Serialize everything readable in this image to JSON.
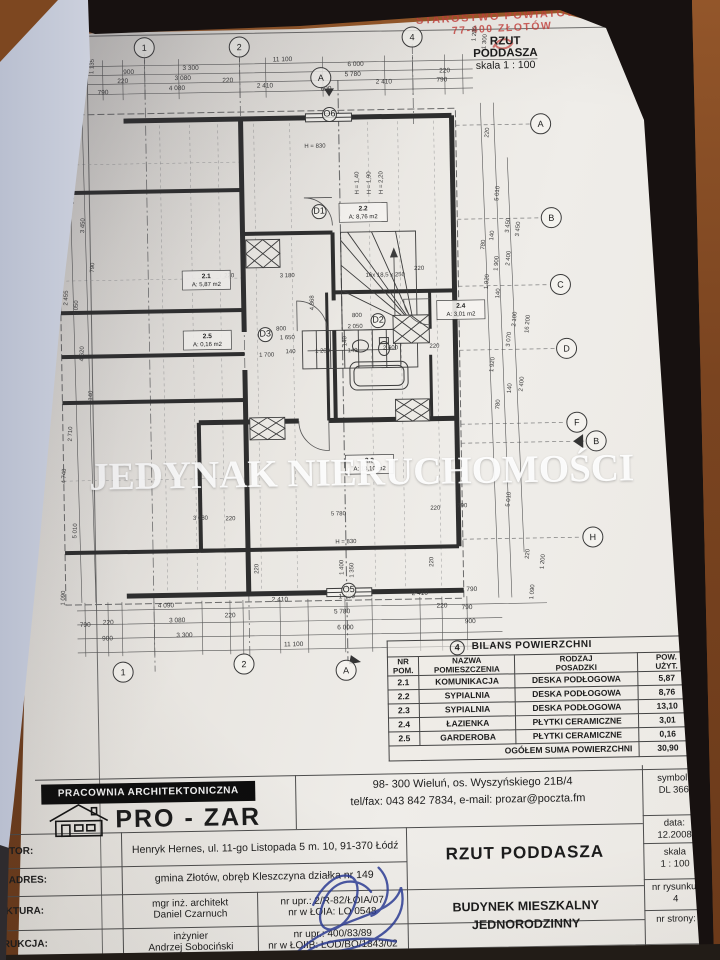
{
  "stamp": {
    "line1": "STAROSTWO POWIATOWE",
    "line2": "77-400 ZŁOTÓW"
  },
  "plan_header": {
    "line1": "RZUT",
    "line2": "PODDASZA",
    "scale": "skala 1 : 100"
  },
  "watermark": "JEDYNAK NIERUCHOMOŚCI",
  "plan": {
    "grid": {
      "top": [
        "1",
        "2",
        "A",
        "4"
      ],
      "bottom": [
        "1",
        "2",
        "A"
      ],
      "right": [
        "A",
        "B",
        "C",
        "D",
        "F",
        "B",
        "H"
      ]
    },
    "refs": [
      "O6",
      "O5",
      "D1",
      "D2",
      "D3"
    ],
    "rooms": [
      {
        "id": "2.1",
        "area": "A: 5,87 m2"
      },
      {
        "id": "2.2",
        "area": "A: 8,76 m2"
      },
      {
        "id": "2.3",
        "area": "A: 13,10 m2"
      },
      {
        "id": "2.4",
        "area": "A: 3,01 m2"
      },
      {
        "id": "2.5",
        "area": "A: 0,16 m2"
      }
    ],
    "dims": {
      "top": [
        "11 100",
        "900",
        "3 300",
        "6 000",
        "220",
        "3 080",
        "220",
        "5 780",
        "220",
        "790",
        "4 080",
        "2 410",
        "600",
        "2 410",
        "790"
      ],
      "bottom": [
        "4 090",
        "2 410",
        "1 400",
        "2 410",
        "790",
        "790",
        "220",
        "3 080",
        "220",
        "5 780",
        "220",
        "790",
        "900",
        "3 300",
        "6 000",
        "900",
        "11 100"
      ],
      "right": [
        "1 280",
        "1 300",
        "220",
        "5 010",
        "3 450",
        "3 450",
        "140",
        "780",
        "1 900",
        "2 400",
        "1 920",
        "140",
        "2 100",
        "16 200",
        "3 070",
        "1 920",
        "140",
        "2 400",
        "780",
        "5 010",
        "220",
        "1 200",
        "1 090"
      ],
      "left": [
        "1 135",
        "140",
        "5 220",
        "3 450",
        "790",
        "2 455",
        "2 050",
        "4 620",
        "140",
        "2 710",
        "4 740",
        "5 010",
        "1 090"
      ],
      "interior": [
        "3 180",
        "220",
        "800",
        "1 650",
        "1 700",
        "140",
        "1 200",
        "140",
        "800",
        "2 050",
        "140",
        "2 600",
        "220",
        "3 080",
        "220",
        "5 780",
        "220",
        "790",
        "H = 830",
        "1 400",
        "1 350",
        "220",
        "220",
        "H = 830",
        "16x 18,5 x 250",
        "4 368",
        "H = 1,40",
        "H = 1,90",
        "H = 2,20",
        "220"
      ]
    }
  },
  "table": {
    "ref": "4",
    "title": "BILANS POWIERZCHNI",
    "headers": [
      [
        "NR",
        "POM."
      ],
      [
        "NAZWA",
        "POMIESZCZENIA"
      ],
      [
        "RODZAJ",
        "POSADZKI"
      ],
      [
        "POW.",
        "UŻYT."
      ]
    ],
    "rows": [
      {
        "nr": "2.1",
        "name": "KOMUNIKACJA",
        "floor": "DESKA PODŁOGOWA",
        "area": "5,87"
      },
      {
        "nr": "2.2",
        "name": "SYPIALNIA",
        "floor": "DESKA PODŁOGOWA",
        "area": "8,76"
      },
      {
        "nr": "2.3",
        "name": "SYPIALNIA",
        "floor": "DESKA PODŁOGOWA",
        "area": "13,10"
      },
      {
        "nr": "2.4",
        "name": "ŁAZIENKA",
        "floor": "PŁYTKI CERAMICZNE",
        "area": "3,01"
      },
      {
        "nr": "2.5",
        "name": "GARDEROBA",
        "floor": "PŁYTKI CERAMICZNE",
        "area": "0,16"
      }
    ],
    "total_label": "OGÓŁEM SUMA POWIERZCHNI",
    "total_value": "30,90"
  },
  "titleblock": {
    "studio_banner": "PRACOWNIA ARCHITEKTONICZNA",
    "studio_name": "PRO - ZAR",
    "address_line1": "98- 300 Wieluń, os. Wyszyńskiego 21B/4",
    "address_line2": "tel/fax: 043 842 7834, e-mail: prozar@poczta.fm",
    "investor_label": "INWESTOR:",
    "investor_value": "Henryk Hernes, ul. 11-go Listopada 5 m. 10, 91-370 Łódź",
    "adres_label": "ADRES:",
    "adres_value": "gmina Złotów, obręb Kleszczyna działka nr 149",
    "architecture": {
      "label": "ARCHITEKTURA:",
      "person1": "mgr inż. architekt",
      "person2": "Daniel Czarnuch",
      "cert1": "nr upr.: 2/R-82/ŁOIA/07",
      "cert2": "nr w ŁOIA: LO 0548"
    },
    "construction": {
      "label": "KONSTRUKCJA:",
      "person1": "inżynier",
      "person2": "Andrzej Sobociński",
      "cert1": "nr upr.: 400/83/89",
      "cert2": "nr w ŁOIIB: ŁOD/BO/1843/02"
    },
    "drawing_title": "RZUT PODDASZA",
    "building": {
      "line1": "BUDYNEK MIESZKALNY",
      "line2": "JEDNORODZINNY"
    },
    "meta": {
      "symbol_label": "symbol:",
      "symbol": "DL 366",
      "date_label": "data:",
      "date": "12.2008",
      "scale_label": "skala",
      "scale": "1 : 100",
      "drawing_no_label": "nr rysunku:",
      "drawing_no": "4",
      "page_label": "nr strony:"
    },
    "colors": {
      "accent_stamp": "#c4403c",
      "signature_blue": "#2c3c96",
      "cover_black": "#171110",
      "table_brown": "#7a4420"
    }
  }
}
